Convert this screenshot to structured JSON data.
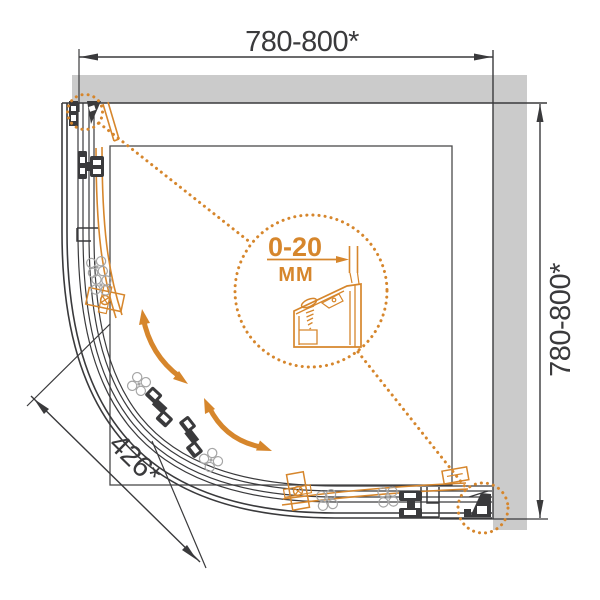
{
  "drawing": {
    "dimensions": {
      "width_top": "780-800*",
      "height_right": "780-800*",
      "entry_radius": "426*"
    },
    "detail": {
      "range": "0-20",
      "unit": "ММ"
    },
    "colors": {
      "accent_orange": "#D6862C",
      "line_dark": "#3A3A3C",
      "wall_gray": "#CBCBCB",
      "roller_gray": "#A5A5A5"
    }
  }
}
